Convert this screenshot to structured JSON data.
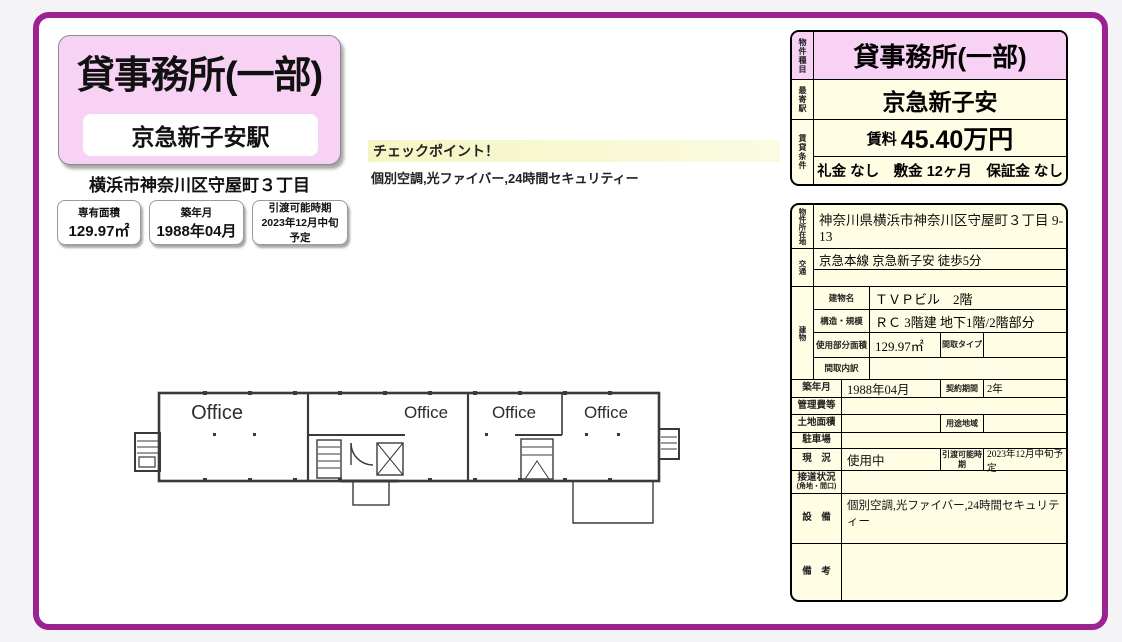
{
  "theme": {
    "border_purple": "#9c2191",
    "pink": "#f8d2f4",
    "cream": "#fffde3",
    "checkpoint_yellow": "#f5f5c4"
  },
  "header": {
    "title": "貸事務所(一部)",
    "station": "京急新子安駅",
    "address": "横浜市神奈川区守屋町３丁目",
    "badges": [
      {
        "label": "専有面積",
        "value": "129.97㎡"
      },
      {
        "label": "築年月",
        "value": "1988年04月"
      },
      {
        "label": "引渡可能時期",
        "value": "2023年12月中旬予定"
      }
    ]
  },
  "checkpoint": {
    "title": "チェックポイント！",
    "features": "個別空調,光ファイバー,24時間セキュリティー"
  },
  "floorplan": {
    "room_labels": [
      "Office",
      "Office",
      "Office",
      "Office"
    ]
  },
  "summary_table": {
    "type_label": "物件種目",
    "type_value": "貸事務所(一部)",
    "station_label": "最寄駅",
    "station_value": "京急新子安",
    "terms_label": "賃貸条件",
    "rent_label": "賃料",
    "rent_value": "45.40万円",
    "terms_value": "礼金 なし　敷金 12ヶ月　保証金 なし"
  },
  "detail_table": {
    "location_label": "物件所在地",
    "location_value": "神奈川県横浜市神奈川区守屋町３丁目 9-13",
    "access_label": "交通",
    "access_value": "京急本線 京急新子安 徒歩5分",
    "building_label": "建物",
    "building_rows": [
      {
        "label": "建物名",
        "value": "ＴＶＰビル　2階"
      },
      {
        "label": "構造・規模",
        "value": "ＲＣ 3階建 地下1階/2階部分"
      },
      {
        "label": "使用部分面積",
        "value": "129.97㎡",
        "sub_label": "間取タイプ",
        "sub_value": ""
      },
      {
        "label": "間取内訳",
        "value": ""
      }
    ],
    "rows": [
      {
        "label": "築年月",
        "value": "1988年04月",
        "sub_label": "契約期間",
        "sub_value": "2年"
      },
      {
        "label": "管理費等",
        "value": ""
      },
      {
        "label": "土地面積",
        "value": "",
        "sub_label": "用途地域",
        "sub_value": ""
      },
      {
        "label": "駐車場",
        "value": ""
      },
      {
        "label": "現　況",
        "value": "使用中",
        "sub_label": "引渡可能時期",
        "sub_value": "2023年12月中旬予定"
      },
      {
        "label": "接道状況",
        "label_sub": "(角地・間口)",
        "value": ""
      },
      {
        "label": "設　備",
        "value": "個別空調,光ファイバー,24時間セキュリティー"
      },
      {
        "label": "備　考",
        "value": ""
      }
    ]
  }
}
